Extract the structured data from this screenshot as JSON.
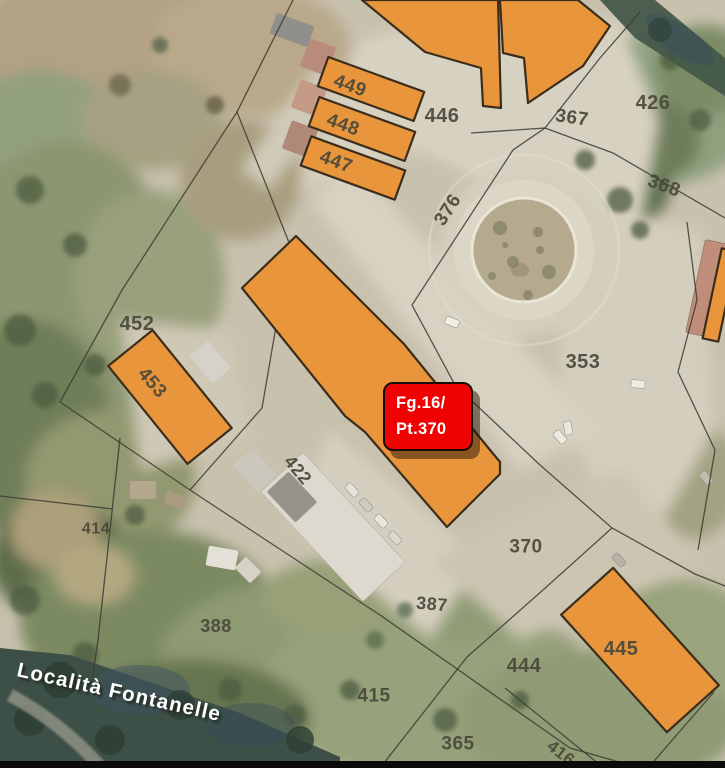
{
  "map": {
    "description": "Cadastral parcel overlay on satellite photo",
    "colors": {
      "building_fill": "#e8953c",
      "building_stroke": "#3a2d1b",
      "parcel_line": "#3c3c33",
      "label_color": "#4a4839",
      "marker_bg": "#ee0202",
      "marker_border": "#170d06",
      "marker_text_color": "#ffffff",
      "street_text_color": "#ffffff"
    },
    "marker": {
      "line1": "Fg.16/",
      "line2": "Pt.370",
      "x": 383,
      "y": 382,
      "width": 90,
      "height": 69
    },
    "street_label": {
      "text": "Località Fontanelle",
      "x": 16,
      "y": 676,
      "rotate": 12.5
    },
    "parcel_labels": [
      {
        "id": "449",
        "x": 350,
        "y": 86,
        "rot": 20,
        "size": 19
      },
      {
        "id": "448",
        "x": 343,
        "y": 125,
        "rot": 20,
        "size": 19
      },
      {
        "id": "447",
        "x": 336,
        "y": 162,
        "rot": 20,
        "size": 19
      },
      {
        "id": "446",
        "x": 442,
        "y": 116,
        "rot": 0,
        "size": 20
      },
      {
        "id": "426",
        "x": 653,
        "y": 103,
        "rot": 0,
        "size": 20
      },
      {
        "id": "367",
        "x": 572,
        "y": 118,
        "rot": 8,
        "size": 19
      },
      {
        "id": "368",
        "x": 664,
        "y": 186,
        "rot": 20,
        "size": 19
      },
      {
        "id": "376",
        "x": 448,
        "y": 210,
        "rot": -57,
        "size": 19
      },
      {
        "id": "353",
        "x": 583,
        "y": 362,
        "rot": 0,
        "size": 20
      },
      {
        "id": "452",
        "x": 137,
        "y": 324,
        "rot": 0,
        "size": 20
      },
      {
        "id": "453",
        "x": 152,
        "y": 383,
        "rot": 49,
        "size": 19
      },
      {
        "id": "422",
        "x": 298,
        "y": 470,
        "rot": 50,
        "size": 18
      },
      {
        "id": "414",
        "x": 96,
        "y": 529,
        "rot": 0,
        "size": 16
      },
      {
        "id": "388",
        "x": 216,
        "y": 626,
        "rot": 0,
        "size": 18
      },
      {
        "id": "387",
        "x": 432,
        "y": 604,
        "rot": 5,
        "size": 18
      },
      {
        "id": "370",
        "x": 526,
        "y": 547,
        "rot": 0,
        "size": 19
      },
      {
        "id": "444",
        "x": 524,
        "y": 666,
        "rot": 0,
        "size": 20
      },
      {
        "id": "445",
        "x": 621,
        "y": 649,
        "rot": 0,
        "size": 20
      },
      {
        "id": "415",
        "x": 374,
        "y": 696,
        "rot": 0,
        "size": 19
      },
      {
        "id": "365",
        "x": 458,
        "y": 744,
        "rot": 0,
        "size": 19
      },
      {
        "id": "416",
        "x": 561,
        "y": 753,
        "rot": 38,
        "size": 17
      }
    ],
    "buildings": [
      {
        "id": "top-center",
        "type": "poly",
        "points": [
          "362,0",
          "498,0",
          "501,108",
          "483,106",
          "481,68",
          "425,52"
        ]
      },
      {
        "id": "top-right",
        "type": "poly",
        "points": [
          "500,0",
          "578,0",
          "610,26",
          "583,66",
          "528,103",
          "524,58",
          "503,53"
        ]
      },
      {
        "id": "bar-449",
        "type": "rect",
        "cx": 371,
        "cy": 89,
        "w": 102,
        "h": 31,
        "rot": 20
      },
      {
        "id": "bar-448",
        "type": "rect",
        "cx": 362,
        "cy": 129,
        "w": 102,
        "h": 31,
        "rot": 20
      },
      {
        "id": "bar-447",
        "type": "rect",
        "cx": 353,
        "cy": 168,
        "w": 100,
        "h": 31,
        "rot": 20
      },
      {
        "id": "central-pt370",
        "type": "poly",
        "points": [
          "296,236",
          "404,344",
          "490,450",
          "500,462",
          "500,474",
          "447,527",
          "365,432",
          "345,416",
          "242,288"
        ]
      },
      {
        "id": "bldg-453",
        "type": "rect",
        "cx": 170,
        "cy": 397,
        "w": 126,
        "h": 57,
        "rot": 51
      },
      {
        "id": "bldg-445",
        "type": "rect",
        "cx": 640,
        "cy": 650,
        "w": 158,
        "h": 70,
        "rot": 48
      },
      {
        "id": "right-edge-sliver",
        "type": "rect",
        "cx": 720,
        "cy": 295,
        "w": 16,
        "h": 92,
        "rot": 12
      }
    ],
    "boundary_lines": [
      {
        "id": "l1",
        "points": [
          "293,0",
          "237,112",
          "122,290",
          "60,402"
        ]
      },
      {
        "id": "l2",
        "points": [
          "60,402",
          "190,490",
          "380,615",
          "570,748",
          "640,768"
        ]
      },
      {
        "id": "l3",
        "points": [
          "120,438",
          "98,640",
          "91,688"
        ]
      },
      {
        "id": "l4",
        "points": [
          "640,12",
          "600,58",
          "545,128",
          "513,150",
          "412,305",
          "455,385",
          "540,465",
          "612,528",
          "695,574",
          "725,586"
        ]
      },
      {
        "id": "l5",
        "points": [
          "471,133",
          "545,128",
          "613,153",
          "725,218"
        ]
      },
      {
        "id": "l6",
        "points": [
          "687,222",
          "697,300",
          "678,372",
          "715,450",
          "698,550"
        ]
      },
      {
        "id": "l7",
        "points": [
          "612,528",
          "543,590",
          "467,657",
          "380,768"
        ]
      },
      {
        "id": "l8",
        "points": [
          "505,688",
          "600,765"
        ]
      },
      {
        "id": "l9",
        "points": [
          "237,112",
          "290,245",
          "262,408",
          "190,490"
        ]
      },
      {
        "id": "l10",
        "points": [
          "714,692",
          "648,768"
        ]
      },
      {
        "id": "l11",
        "points": [
          "0,496",
          "113,509"
        ]
      }
    ]
  }
}
